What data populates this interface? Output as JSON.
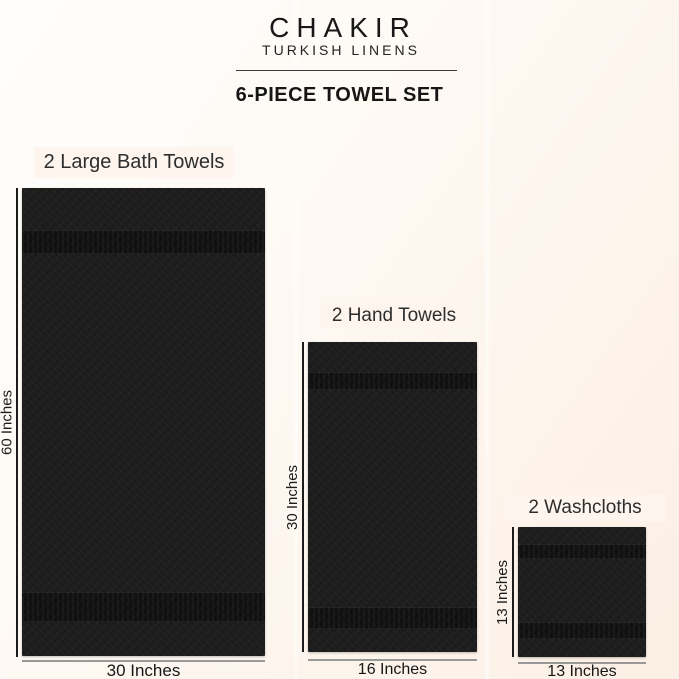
{
  "header": {
    "brand": "CHAKIR",
    "tagline": "TURKISH LINENS",
    "title": "6-PIECE TOWEL SET"
  },
  "towels": [
    {
      "label": "2 Large Bath Towels",
      "height_label": "60 Inches",
      "width_label": "30 Inches"
    },
    {
      "label": "2 Hand Towels",
      "height_label": "30 Inches",
      "width_label": "16 Inches"
    },
    {
      "label": "2 Washcloths",
      "height_label": "13 Inches",
      "width_label": "13 Inches"
    }
  ],
  "colors": {
    "background_top_left": "#fffefd",
    "background_bottom_right": "#fcefe4",
    "label_box": "#fef5ee",
    "towel": "#1b1b1b",
    "text_dark": "#1e1e1e",
    "measure_line_vertical": "#1c1c1c",
    "measure_line_horizontal": "#999999"
  }
}
